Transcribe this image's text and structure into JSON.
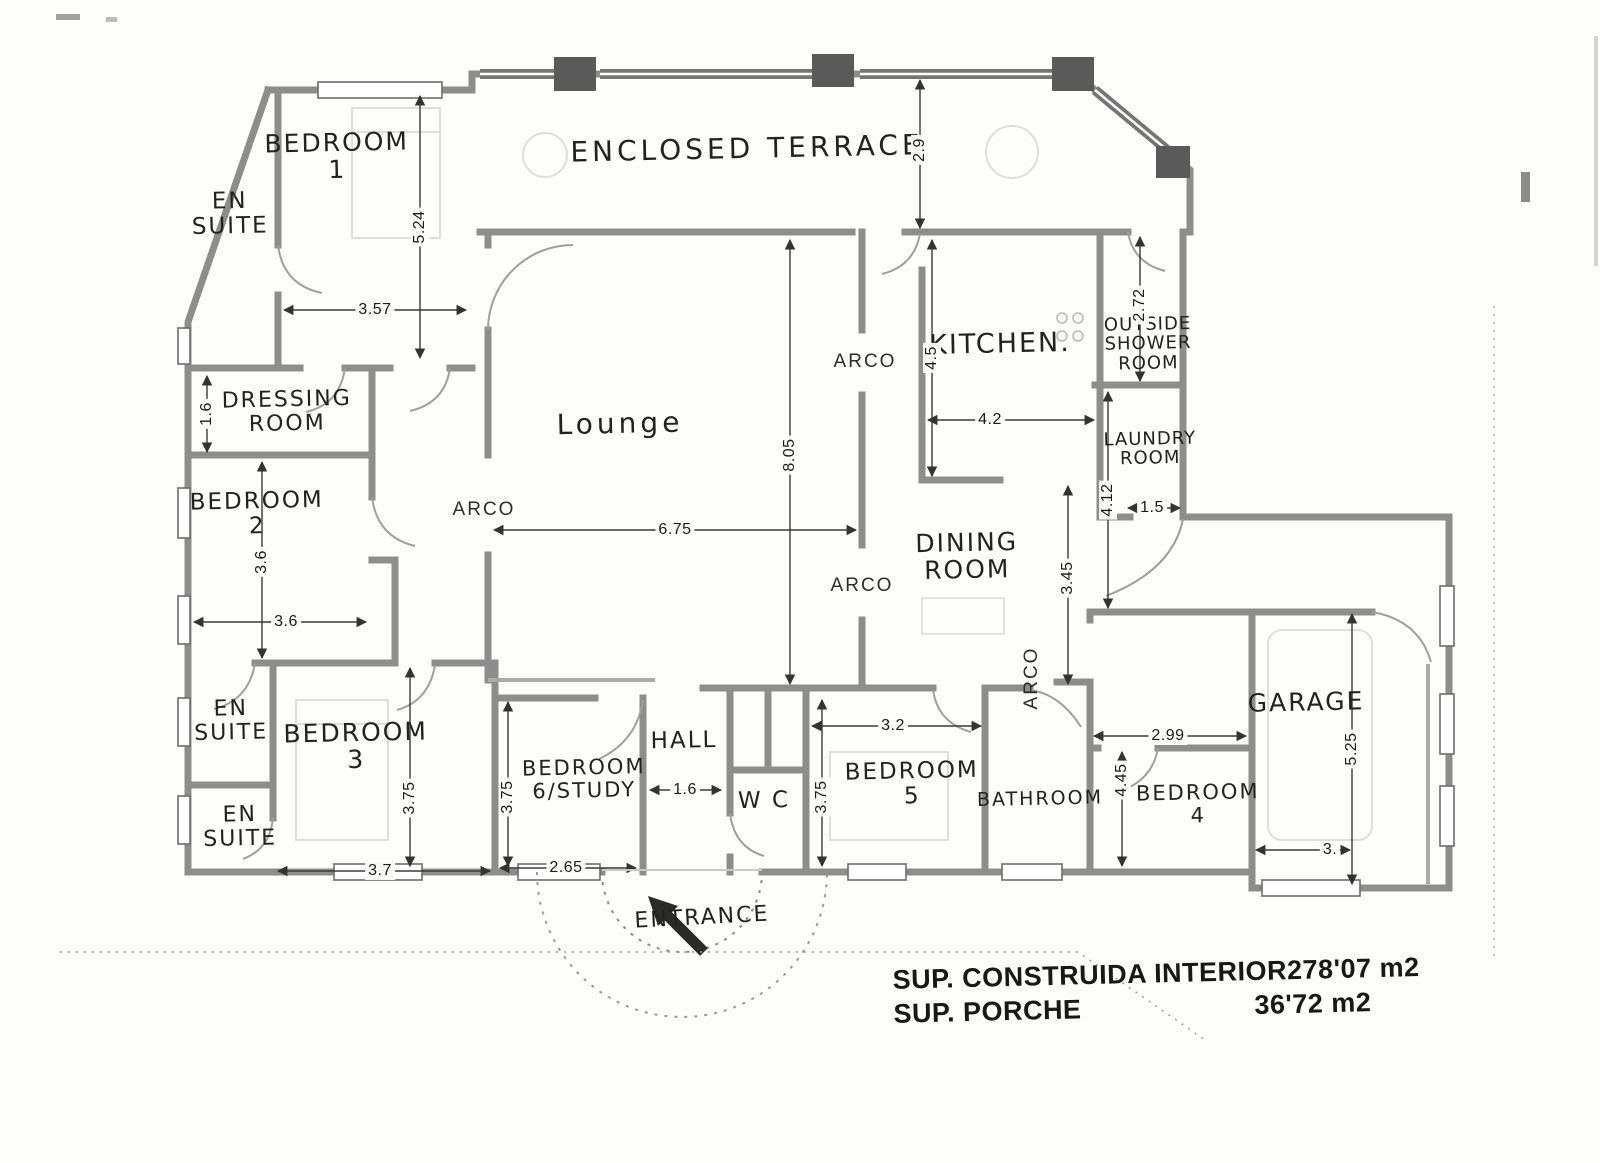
{
  "document": {
    "kind": "scanned hand-annotated house floor plan"
  },
  "rooms": {
    "bedroom_1": {
      "l1": "BEDROOM",
      "l2": "1"
    },
    "en_suite_top": {
      "l1": "EN",
      "l2": "SUITE"
    },
    "enclosed_terrace": {
      "l1": "ENCLOSED TERRACE"
    },
    "dressing_room": {
      "l1": "DRESSING",
      "l2": "ROOM"
    },
    "bedroom_2": {
      "l1": "BEDROOM",
      "l2": "2"
    },
    "lounge": {
      "l1": "Lounge"
    },
    "kitchen": {
      "l1": "KITCHEN."
    },
    "outside_shower_room": {
      "l1": "OUTSIDE",
      "l2": "SHOWER",
      "l3": "ROOM"
    },
    "laundry_room": {
      "l1": "LAUNDRY",
      "l2": "ROOM"
    },
    "dining_room": {
      "l1": "DINING",
      "l2": "ROOM"
    },
    "en_suite_mid": {
      "l1": "EN",
      "l2": "SUITE"
    },
    "bedroom_3": {
      "l1": "BEDROOM",
      "l2": "3"
    },
    "en_suite_bottom": {
      "l1": "EN",
      "l2": "SUITE"
    },
    "hall": {
      "l1": "HALL"
    },
    "bedroom_6_study": {
      "l1": "BEDROOM",
      "l2": "6/STUDY"
    },
    "wc": {
      "l1": "W C"
    },
    "bedroom_5": {
      "l1": "BEDROOM",
      "l2": "5"
    },
    "bathroom": {
      "l1": "BATHROOM"
    },
    "bedroom_4": {
      "l1": "BEDROOM",
      "l2": "4"
    },
    "garage": {
      "l1": "GARAGE"
    },
    "entrance": {
      "l1": "ENTRANCE"
    }
  },
  "arch_openings": {
    "label": "ARCO",
    "count": 4
  },
  "dimensions_m": {
    "bedroom1_height": "5.24",
    "bedroom1_width": "3.57",
    "dressing_room_height": "1.6",
    "terrace_depth": "2.9",
    "kitchen_height": "4.5",
    "kitchen_width": "4.2",
    "outside_shower_height": "2.72",
    "lounge_height": "8.05",
    "lounge_width": "6.75",
    "bedroom2_height": "3.6",
    "bedroom2_width": "3.6",
    "laundry_height": "4.12",
    "laundry_width": "1.5",
    "dining_height": "3.45",
    "bedroom3_height": "3.75",
    "bedroom3_width": "3.7",
    "bedroom6_height": "3.75",
    "bedroom6_width": "2.65",
    "hall_width": "1.6",
    "bedroom5_height": "3.75",
    "bedroom5_width": "3.2",
    "bedroom4_width": "2.99",
    "bedroom4_height": "4.45",
    "garage_height": "5.25",
    "garage_width": "3."
  },
  "area_summary": {
    "construida_label": "SUP. CONSTRUIDA INTERIOR",
    "construida_value": "278'07 m2",
    "porche_label": "SUP. PORCHE",
    "porche_value": "36'72 m2"
  }
}
